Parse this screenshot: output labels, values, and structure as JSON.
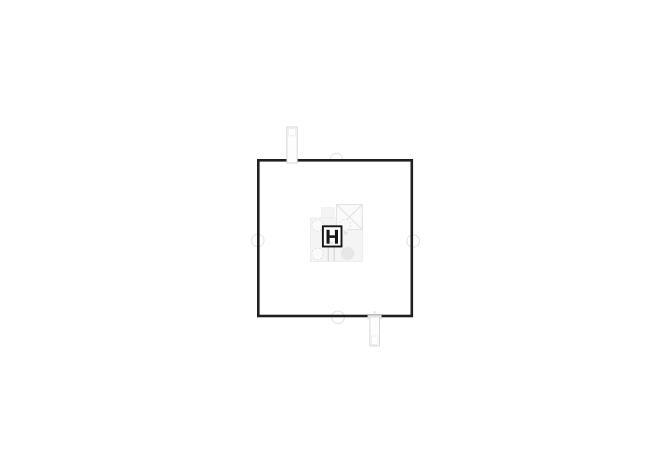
{
  "plan": {
    "kind": "architectural-floor-plan",
    "visible_text": "",
    "elements": [
      "outer-wall-square",
      "chimney-fixture-top",
      "duct-fixture-bottom",
      "door-arc-symbol-top-wall",
      "circle-symbol-left-wall",
      "circle-symbol-right-wall",
      "circle-symbol-bottom-wall",
      "central-core-plate",
      "x-marked-shaft",
      "dashed-column-circles",
      "filled-column-circle",
      "h-shaft-symbol"
    ]
  },
  "colors": {
    "page_bg": "#ffffff",
    "wall": "#202020",
    "core_outline": "#161616",
    "fixture_line": "#d6d6d6",
    "fixture_fill": "#fdfdfd",
    "faint_line": "#e2e2e2",
    "plate_fill": "#f4f4f4",
    "plate_line": "#ececec",
    "xbox_fill": "#fafafa",
    "filled_circle_fill": "#e7e7e7",
    "detail_line": "#d9d9d9",
    "wall_pass_fill": "#e3e3e3"
  }
}
